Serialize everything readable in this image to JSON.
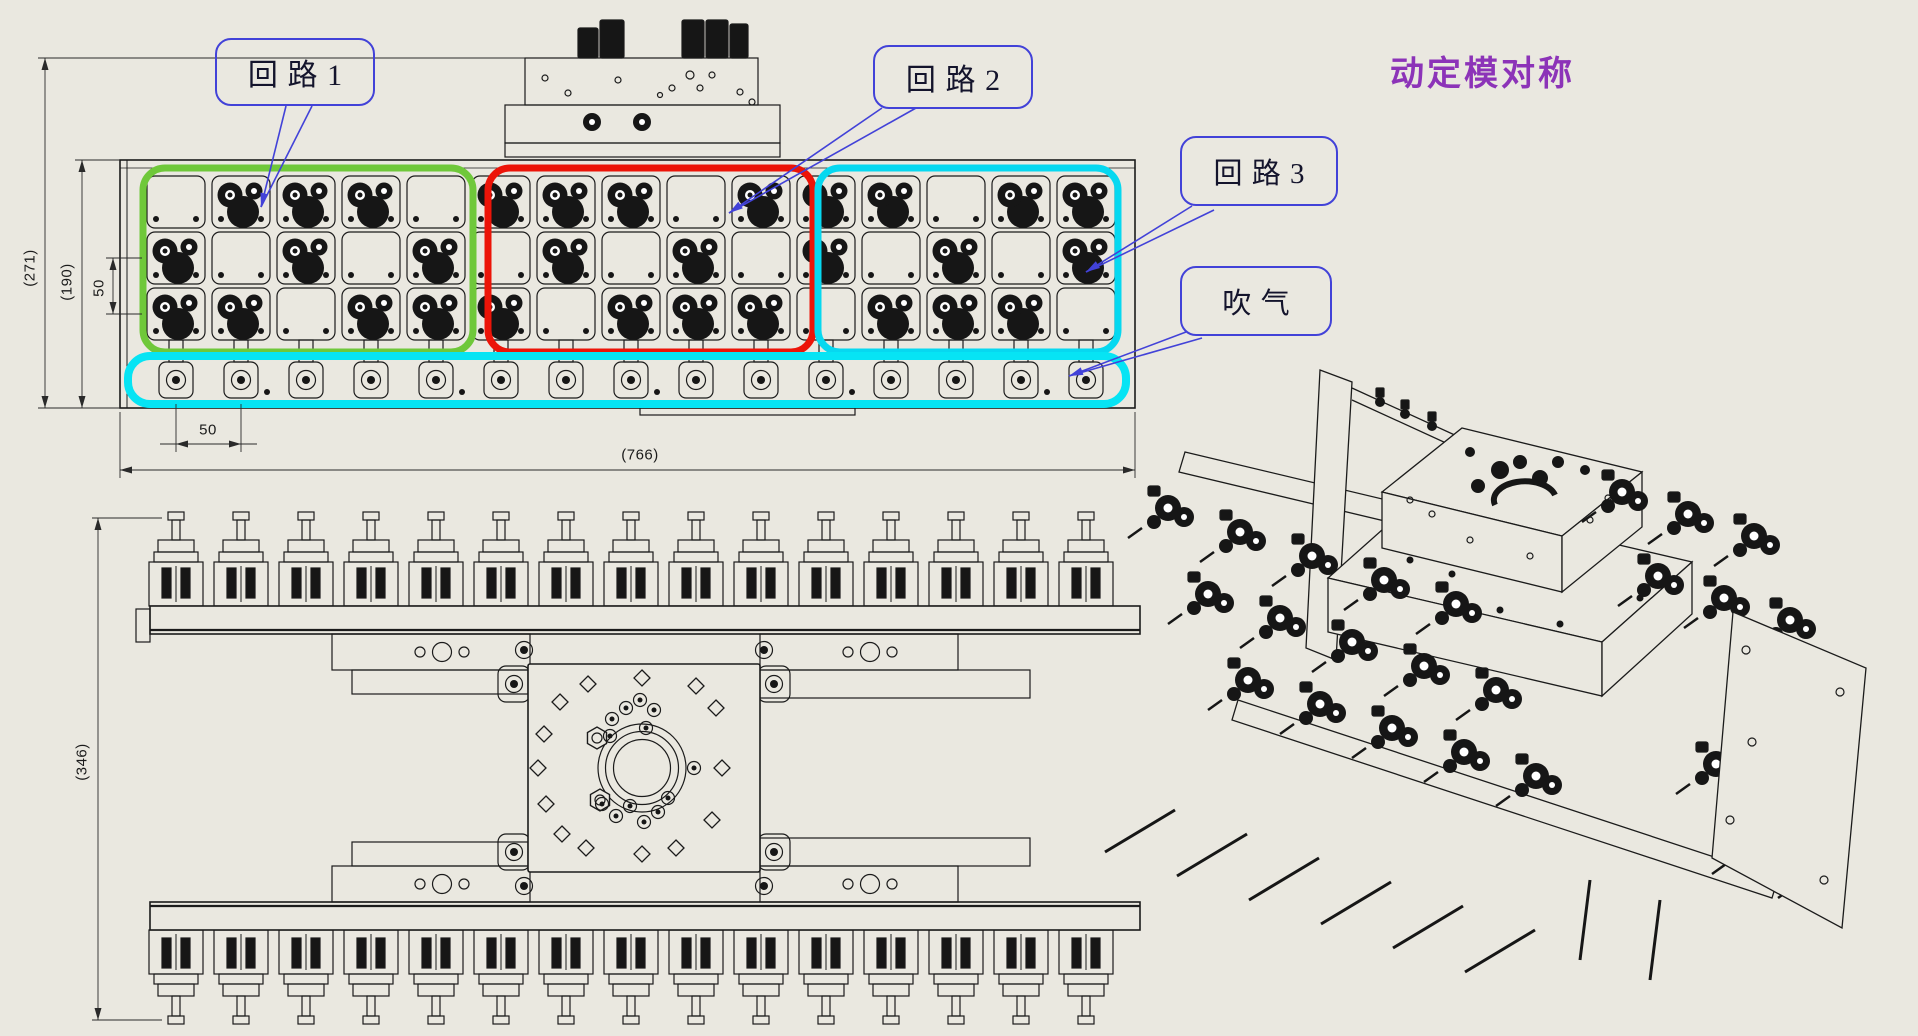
{
  "title": {
    "text": "动定模对称",
    "color": "#8c33b8"
  },
  "callouts": [
    {
      "id": "loop1",
      "label": "回路1"
    },
    {
      "id": "loop2",
      "label": "回路2"
    },
    {
      "id": "loop3",
      "label": "回路3"
    },
    {
      "id": "blow",
      "label": "吹气"
    }
  ],
  "dimensions": {
    "overall_height": "(271)",
    "plate_height": "(190)",
    "row_pitch": "50",
    "col_pitch": "50",
    "overall_width": "(766)",
    "front_height": "(346)"
  },
  "colors": {
    "background": "#eae8e0",
    "line": "#1b1b1b",
    "dark_fill": "#161616",
    "loop1_region": "#6fc83a",
    "loop2_region": "#ec1408",
    "loop3_region": "#06d8f0",
    "blow_region": "#06e4f4",
    "callout_blue": "#4242d8",
    "title_purple": "#8c33b8"
  },
  "top_view": {
    "grid_cols": 15,
    "gripper_rows": [
      [
        0,
        1,
        1,
        1,
        0,
        1,
        1,
        1,
        0,
        1,
        1,
        1,
        0,
        1,
        1
      ],
      [
        1,
        0,
        1,
        0,
        1,
        0,
        1,
        0,
        1,
        0,
        1,
        0,
        1,
        0,
        1
      ],
      [
        1,
        1,
        0,
        1,
        1,
        1,
        0,
        1,
        1,
        1,
        0,
        1,
        1,
        1,
        0
      ]
    ],
    "nozzle_count": 15,
    "regions": [
      {
        "label": "回路1",
        "cols": "0-4"
      },
      {
        "label": "回路2",
        "cols": "5-9"
      },
      {
        "label": "回路3",
        "cols": "10-14"
      },
      {
        "label": "吹气",
        "cols": "bottom-strip"
      }
    ]
  },
  "front_view": {
    "cylinders_top": 15,
    "cylinders_bottom": 15
  },
  "iso_view": {
    "cluster_bands": [
      {
        "cols": 5,
        "rows": 3
      },
      {
        "cols": 3,
        "rows": 2
      },
      {
        "cols": 2,
        "rows": 2
      }
    ]
  }
}
